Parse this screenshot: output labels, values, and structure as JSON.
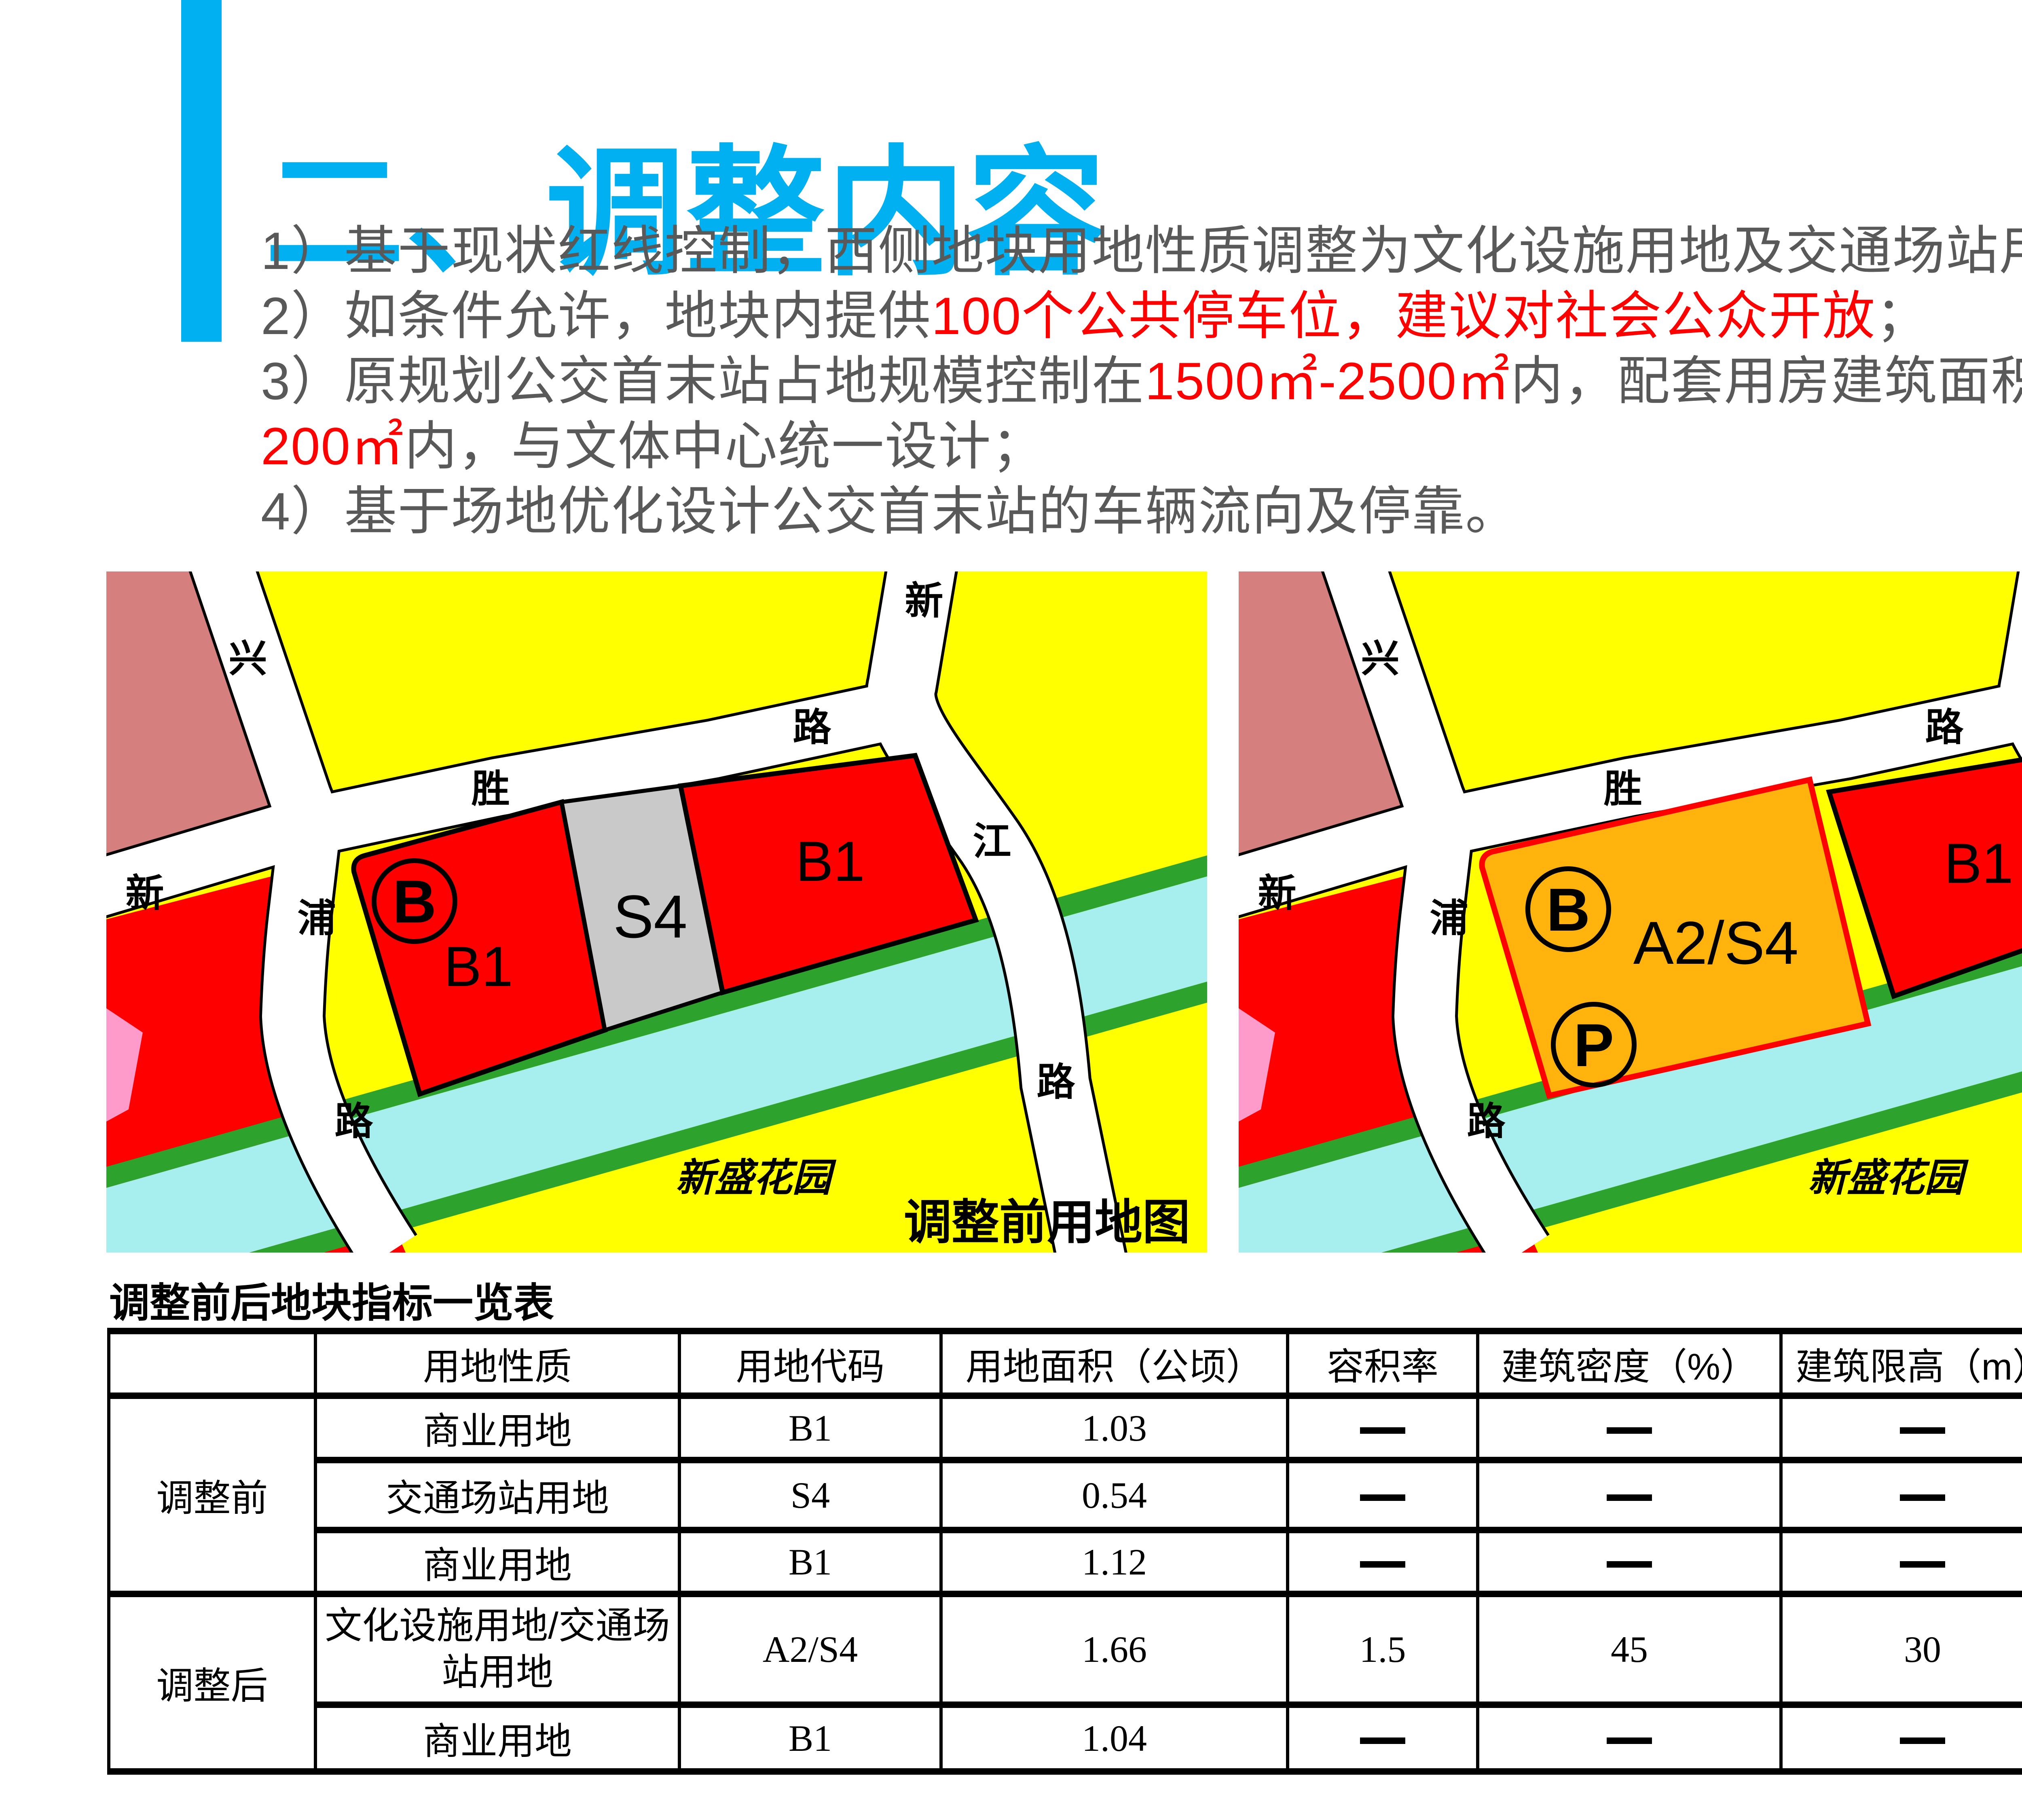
{
  "slide_title": "二、调整内容",
  "accent_color": "#00B0F0",
  "points": {
    "p1": "1）基于现状红线控制，西侧地块用地性质调整为文化设施用地及交通场站用地；",
    "p2_pre": "2）如条件允许，地块内提供",
    "p2_red": "100个公共停车位，建议对社会公众开放",
    "p2_end": "；",
    "p3_pre": "3）原规划公交首末站占地规模控制在",
    "p3_red": "1500㎡-2500㎡",
    "p3_end": "内，配套用房建筑面积控制在",
    "p4_red": "200㎡",
    "p4_end": "内，与文体中心统一设计；",
    "p5": "4）基于场地优化设计公交首末站的车辆流向及停靠。"
  },
  "maps": {
    "road_labels": {
      "xing": "兴",
      "xin_w": "新",
      "pu": "浦",
      "lu_w": "路",
      "sheng": "胜",
      "lu_mid": "路",
      "xin_e": "新",
      "jiang": "江",
      "lu_e": "路"
    },
    "garden": "新盛花园",
    "before": {
      "caption": "调整前用地图",
      "b_marker": "B",
      "left_parcel": "B1",
      "mid_parcel": "S4",
      "right_parcel": "B1"
    },
    "after": {
      "caption": "调整后用地图",
      "b_marker": "B",
      "p_marker": "P",
      "mid_parcel": "A2/S4",
      "right_parcel": "B1"
    },
    "colors": {
      "residential_yellow": "#FFFF00",
      "salmon_block": "#D5807E",
      "commercial_red": "#FE0000",
      "transport_gray": "#C9C9C9",
      "culture_orange": "#FFB30C",
      "river_cyan": "#A7EFEF",
      "green_belt": "#2DA32D",
      "pink_block": "#FF9BCB"
    }
  },
  "table": {
    "title": "调整前后地块指标一览表",
    "headers": {
      "nature": "用地性质",
      "code": "用地代码",
      "area": "用地面积（公顷）",
      "far": "容积率",
      "density": "建筑密度（%）",
      "height": "建筑限高（m）",
      "green": "绿化率（%）"
    },
    "group_before": {
      "label": "调整前",
      "rows": [
        {
          "nature": "商业用地",
          "code": "B1",
          "area": "1.03",
          "far": "——",
          "density": "——",
          "height": "——",
          "green": "——"
        },
        {
          "nature": "交通场站用地",
          "code": "S4",
          "area": "0.54",
          "far": "——",
          "density": "——",
          "height": "——",
          "green": "——"
        },
        {
          "nature": "商业用地",
          "code": "B1",
          "area": "1.12",
          "far": "——",
          "density": "——",
          "height": "——",
          "green": "——"
        }
      ]
    },
    "group_after": {
      "label": "调整后",
      "rows": [
        {
          "nature": "文化设施用地/交通场站用地",
          "code": "A2/S4",
          "area": "1.66",
          "far": "1.5",
          "density": "45",
          "height": "30",
          "green": "20"
        },
        {
          "nature": "商业用地",
          "code": "B1",
          "area": "1.04",
          "far": "——",
          "density": "——",
          "height": "——",
          "green": "——"
        }
      ]
    }
  }
}
